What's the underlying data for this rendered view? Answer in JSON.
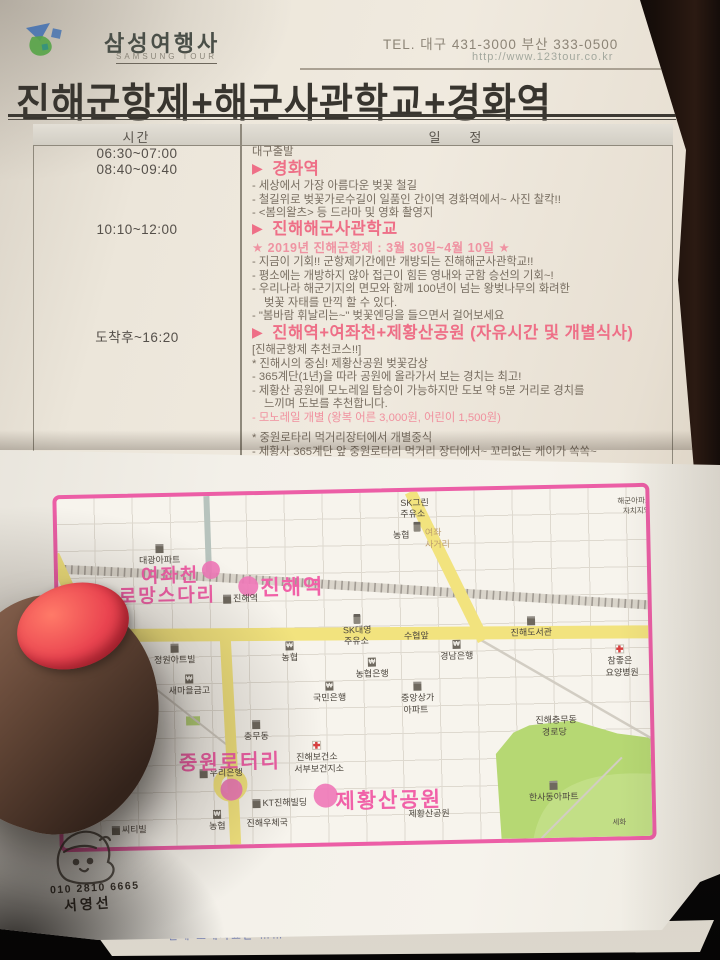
{
  "header": {
    "brand": "삼성여행사",
    "brand_sub": "SAMSUNG TOUR",
    "tel": "TEL. 대구 431-3000 부산 333-0500",
    "url": "http://www.123tour.co.kr"
  },
  "title": "진해군항제+해군사관학교+경화역",
  "schedule": {
    "col_time": "시간",
    "col_detail": "일        정",
    "sections": [
      {
        "time": "06:30~07:00",
        "lines": [
          {
            "s": "plain",
            "t": "대구출발"
          }
        ]
      },
      {
        "time": "08:40~09:40",
        "lines": [
          {
            "s": "header",
            "t": "경화역"
          },
          {
            "s": "plain",
            "t": "- 세상에서 가장 아름다운 벚꽃 철길"
          },
          {
            "s": "plain",
            "t": "- 철길위로 벚꽃가로수길이 일품인 간이역 경화역에서~ 사진 찰칵!!"
          },
          {
            "s": "plain",
            "t": "- <봄의왈츠> 등 드라마 및 영화 촬영지"
          }
        ]
      },
      {
        "time": "10:10~12:00",
        "lines": [
          {
            "s": "header",
            "t": "진해해군사관학교"
          },
          {
            "s": "star",
            "t": "★ 2019년 진해군항제 : 3월 30일~4월 10일 ★"
          },
          {
            "s": "plain",
            "t": "- 지금이 기회!! 군항제기간에만 개방되는 진해해군사관학교!!"
          },
          {
            "s": "plain",
            "t": "- 평소에는 개방하지 않아 접근이 힘든 영내와 군함 승선의 기회~!"
          },
          {
            "s": "plain",
            "t": "- 우리나라 해군기지의 면모와 함께 100년이 넘는 왕벚나무의 화려한"
          },
          {
            "s": "indent",
            "t": "벚꽃 자태를 만끽 할 수 있다."
          },
          {
            "s": "plain",
            "t": "- \"봄바람 휘날리는~\" 벚꽃엔딩을 들으면서 걸어보세요"
          }
        ]
      },
      {
        "time": "도착후~16:20",
        "lines": [
          {
            "s": "header",
            "t": "진해역+여좌천+제황산공원 (자유시간 및 개별식사)"
          },
          {
            "s": "plain",
            "t": "[진해군항제 추천코스!!]"
          },
          {
            "s": "plain",
            "t": "* 진해시의 중심! 제황산공원 벚꽃감상"
          },
          {
            "s": "plain",
            "t": "- 365계단(1년)을 따라 공원에 올라가서 보는 경치는 최고!"
          },
          {
            "s": "plain",
            "t": "- 제황산 공원에 모노레일 탑승이 가능하지만 도보 약 5분 거리로 경치를"
          },
          {
            "s": "indent",
            "t": "느끼며 도보를 추천합니다."
          },
          {
            "s": "pink",
            "t": "- 모노레일 개별 (왕복 어른 3,000원, 어린이 1,500원)"
          },
          {
            "s": "gap",
            "t": ""
          },
          {
            "s": "plain",
            "t": "* 중원로타리 먹거리장터에서 개별중식"
          },
          {
            "s": "plain",
            "t": "- 제황사 365계단 앞 중원로타리 먹거리 장터에서~ 꼬리없는 케이가 쏙쏙~"
          }
        ]
      }
    ]
  },
  "icons": {
    "play": "▶",
    "bank_glyph": "₩"
  },
  "map": {
    "rotary": {
      "l1": "북원",
      "l2": "로터리"
    },
    "big_labels": [
      {
        "t": "여좌천",
        "x": 112,
        "y": 64,
        "s": 19
      },
      {
        "t": "로망스다리",
        "x": 109,
        "y": 84,
        "s": 19
      },
      {
        "t": "진해역",
        "x": 234,
        "y": 77,
        "s": 21
      },
      {
        "t": "중원로터리",
        "x": 168,
        "y": 250,
        "s": 20
      },
      {
        "t": "제황산공원",
        "x": 326,
        "y": 292,
        "s": 21
      }
    ],
    "markers": [
      {
        "x": 153,
        "y": 74,
        "r": 9
      },
      {
        "x": 190,
        "y": 91,
        "r": 10
      },
      {
        "x": 169,
        "y": 294,
        "r": 11
      },
      {
        "x": 263,
        "y": 302,
        "r": 12
      }
    ],
    "labels": [
      {
        "t": "대광아파트",
        "x": 102,
        "y": 58,
        "icon": "bldg",
        "ip": "top"
      },
      {
        "t": "진해역",
        "x": 182,
        "y": 98,
        "icon": "bldg",
        "ip": "left"
      },
      {
        "t": "SK그린",
        "x": 358,
        "y": 6
      },
      {
        "t": "주유소",
        "x": 356,
        "y": 17
      },
      {
        "t": "",
        "x": 360,
        "y": 30,
        "icon": "gas",
        "ip": "only"
      },
      {
        "t": "농협",
        "x": 344,
        "y": 38
      },
      {
        "t": "여좌",
        "x": 376,
        "y": 36,
        "cls": "tan"
      },
      {
        "t": "사거리",
        "x": 380,
        "y": 48,
        "cls": "tan"
      },
      {
        "t": "해군아파트",
        "x": 578,
        "y": 9,
        "cls": "tiny"
      },
      {
        "t": "자치지역",
        "x": 580,
        "y": 19,
        "cls": "tiny"
      },
      {
        "t": "SK대영",
        "x": 298,
        "y": 132,
        "icon": "gas",
        "ip": "top"
      },
      {
        "t": "주유소",
        "x": 297,
        "y": 143
      },
      {
        "t": "수협앞",
        "x": 357,
        "y": 139
      },
      {
        "t": "진해도서관",
        "x": 472,
        "y": 138,
        "icon": "bldg",
        "ip": "top"
      },
      {
        "t": "경남은행",
        "x": 397,
        "y": 160,
        "icon": "bank",
        "ip": "top"
      },
      {
        "t": "농협",
        "x": 230,
        "y": 158,
        "icon": "bank",
        "ip": "top"
      },
      {
        "t": "농협은행",
        "x": 312,
        "y": 176,
        "icon": "bank",
        "ip": "top"
      },
      {
        "t": "국민은행",
        "x": 269,
        "y": 199,
        "icon": "bank",
        "ip": "top"
      },
      {
        "t": "새마을금고",
        "x": 129,
        "y": 189,
        "icon": "bank",
        "ip": "top"
      },
      {
        "t": "정원아트빌",
        "x": 115,
        "y": 158,
        "icon": "bldg",
        "ip": "top"
      },
      {
        "t": "참좋은",
        "x": 560,
        "y": 168,
        "icon": "hosp",
        "ip": "top"
      },
      {
        "t": "요양병원",
        "x": 562,
        "y": 180
      },
      {
        "t": "중앙상가",
        "x": 357,
        "y": 201,
        "icon": "bldg",
        "ip": "top"
      },
      {
        "t": "아파트",
        "x": 355,
        "y": 213
      },
      {
        "t": "진해충무동",
        "x": 495,
        "y": 226
      },
      {
        "t": "경로당",
        "x": 493,
        "y": 238
      },
      {
        "t": "충무동",
        "x": 195,
        "y": 236,
        "icon": "bldg",
        "ip": "top"
      },
      {
        "t": "우리은행",
        "x": 159,
        "y": 272,
        "icon": "bldg",
        "ip": "left"
      },
      {
        "t": "진해보건소",
        "x": 255,
        "y": 258,
        "icon": "hosp",
        "ip": "top"
      },
      {
        "t": "서부보건지소",
        "x": 257,
        "y": 270
      },
      {
        "t": "KT진해빌딩",
        "x": 217,
        "y": 303,
        "icon": "bldg",
        "ip": "left"
      },
      {
        "t": "제황산공원",
        "x": 366,
        "y": 317
      },
      {
        "t": "농협",
        "x": 154,
        "y": 325,
        "icon": "bank",
        "ip": "top"
      },
      {
        "t": "진해우체국",
        "x": 204,
        "y": 323
      },
      {
        "t": "씨티빌",
        "x": 66,
        "y": 327,
        "icon": "bldg",
        "ip": "left"
      },
      {
        "t": "한사동아파트",
        "x": 491,
        "y": 303,
        "icon": "bldg",
        "ip": "top"
      },
      {
        "t": "세화",
        "x": 556,
        "y": 330,
        "cls": "tiny"
      }
    ]
  },
  "stamp": {
    "phone": "010 2810 6665",
    "name": "서영선"
  },
  "peek": {
    "text": "진해 소개자료는 ……"
  }
}
